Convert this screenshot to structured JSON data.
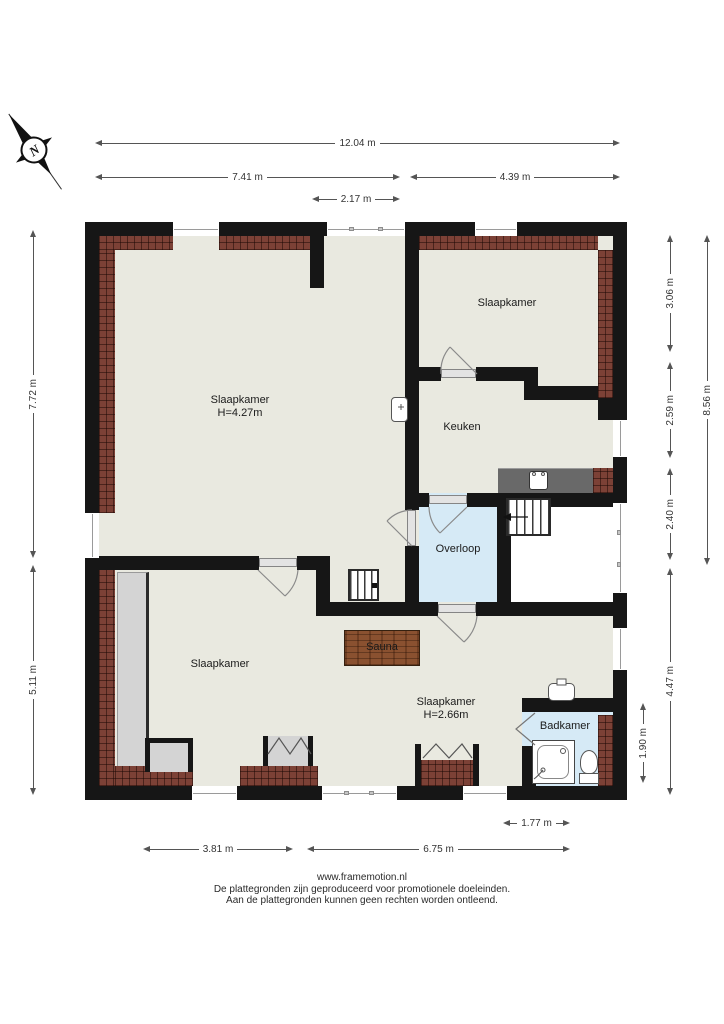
{
  "compass": {
    "label": "N"
  },
  "rooms": [
    {
      "name": "slaapkamer-left",
      "label": "Slaapkamer",
      "height_note": "H=4.27m"
    },
    {
      "name": "slaapkamer-topright",
      "label": "Slaapkamer"
    },
    {
      "name": "keuken",
      "label": "Keuken"
    },
    {
      "name": "overloop",
      "label": "Overloop"
    },
    {
      "name": "slaapkamer-bottomleft",
      "label": "Slaapkamer"
    },
    {
      "name": "slaapkamer-bottomright",
      "label": "Slaapkamer",
      "height_note": "H=2.66m"
    },
    {
      "name": "badkamer",
      "label": "Badkamer"
    },
    {
      "name": "sauna",
      "label": "Sauna"
    }
  ],
  "dimensions": {
    "top": [
      {
        "value": "12.04 m"
      },
      {
        "value": "7.41 m"
      },
      {
        "value": "4.39 m"
      },
      {
        "value": "2.17 m"
      }
    ],
    "left": [
      {
        "value": "7.72 m"
      },
      {
        "value": "5.11 m"
      }
    ],
    "right": [
      {
        "value": "3.06 m"
      },
      {
        "value": "2.59 m"
      },
      {
        "value": "2.40 m"
      },
      {
        "value": "4.47 m"
      },
      {
        "value": "8.56 m"
      },
      {
        "value": "1.90 m"
      }
    ],
    "bottom": [
      {
        "value": "1.77 m"
      },
      {
        "value": "3.81 m"
      },
      {
        "value": "6.75 m"
      }
    ]
  },
  "footer": {
    "website": "www.framemotion.nl",
    "line1": "De plattegronden zijn geproduceerd voor promotionele doeleinden.",
    "line2": "Aan de plattegronden kunnen geen rechten worden ontleend."
  },
  "colors": {
    "wall": "#161616",
    "floor": "#e9e9e0",
    "landing_and_bath": "#d6eaf6",
    "brick": "#7c4136",
    "sauna_wood": "#8a5130",
    "closet_gray": "#d4d4d4"
  }
}
